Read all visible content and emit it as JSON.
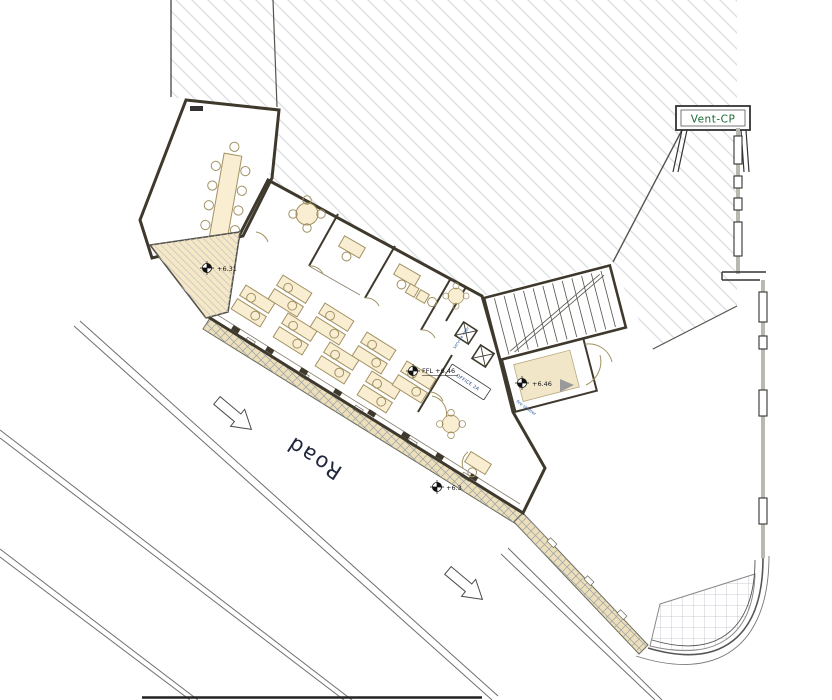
{
  "plan": {
    "road_label": "Road",
    "vent_label": "Vent-CP",
    "office_label": "OFFICE 2A",
    "ffl_label": "FFL +6.46",
    "level_entrance": "+6.46",
    "level_ramp": "+6.31",
    "level_front": "+6.3",
    "fire_shutter_label": "fire shutter",
    "service_riser_label": "service riser"
  },
  "colors": {
    "floor_fill": "#f7e8c5",
    "wall": "#3e392c",
    "furniture": "#a29263",
    "hatch_line": "#dcdfe4",
    "ramp_hatch": "#c9c9c9",
    "pavement_fill": "#ecdfba",
    "pavement_hatch": "#9aa1aa",
    "label_blue": "#2a5caa",
    "label_green": "#1c6b33",
    "road_text": "#20263c",
    "grid_line": "#b9bec6"
  }
}
